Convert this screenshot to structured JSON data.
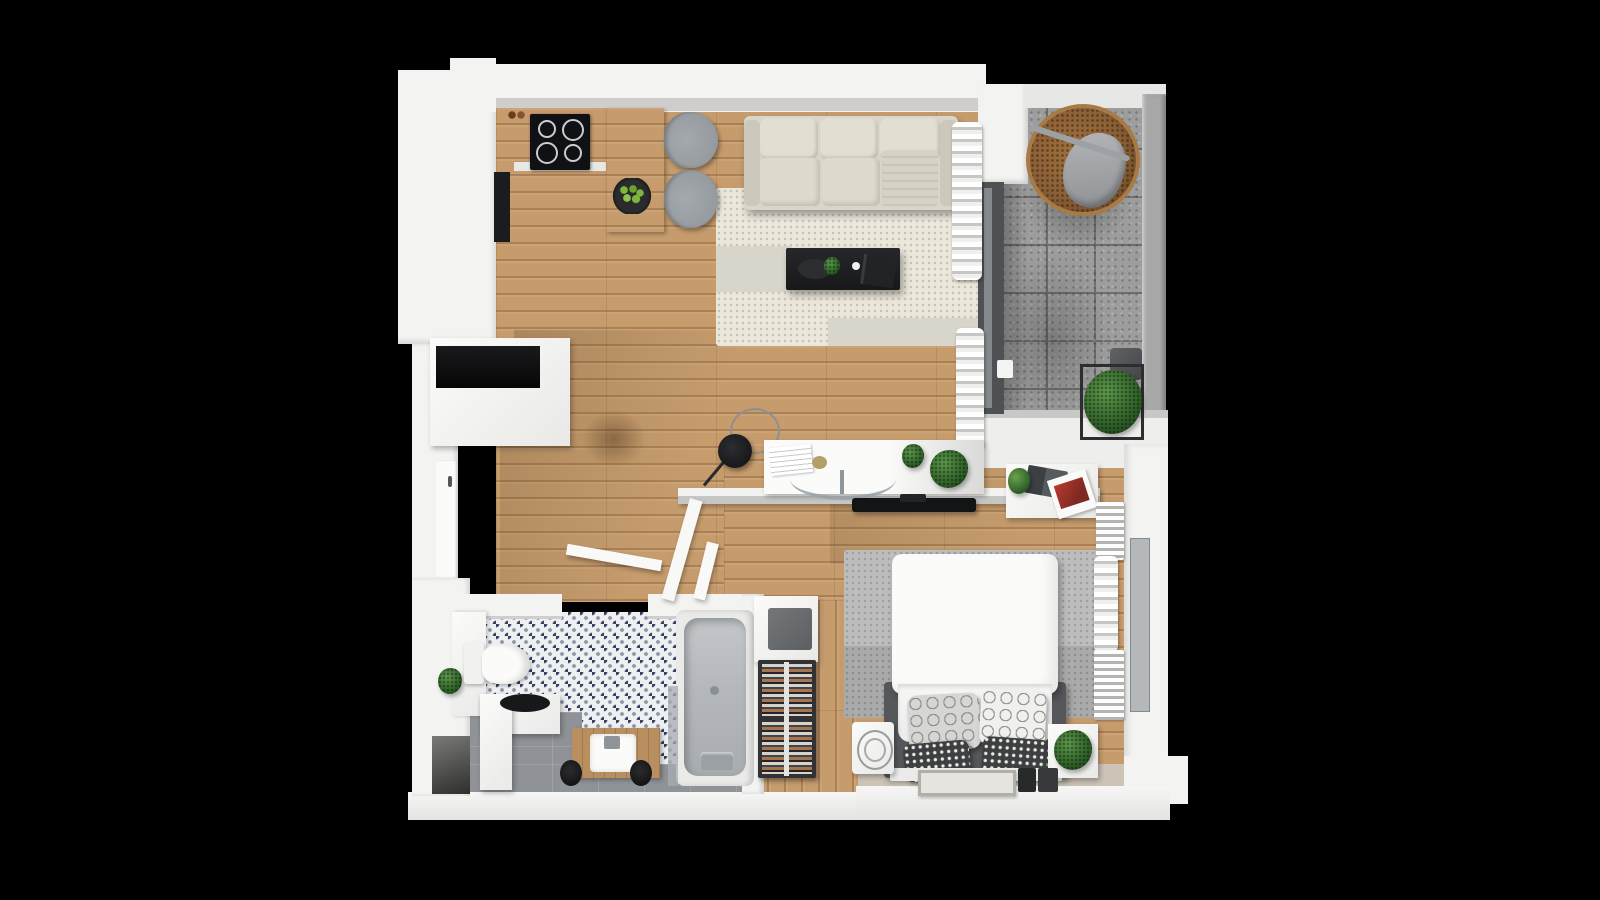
{
  "scene": {
    "type": "3d-floor-plan-top-view",
    "description": "Top-down 3D render of a one-bedroom apartment floor plan on a black background",
    "background": "#000000"
  },
  "palette": {
    "bg": "#000000",
    "wall": "#f3f3f1",
    "wallShade": "#d7d6d4",
    "wallLip": "#cfcecc",
    "wood": "#c69c6d",
    "woodVanity": "#b98f5f",
    "rugCream": "#ebe7db",
    "rugGrayPatch": "#d8d5cb",
    "bedroomRug": "#bdbdbd",
    "bedroomRugDark": "#aaaaaa",
    "balcony": "#9d9d9d",
    "grout": "#6e6e6e",
    "railing": "#a8a8a8",
    "glassWall": "#4e5154",
    "glassLine": "#84898c",
    "tileBase": "#edeff1",
    "tileNavy": "#36425f",
    "tileGray": "#8d95a5",
    "grayTile": "#8f9296",
    "sofa": "#d9d5c9",
    "sofaCushion": "#e2ded2",
    "blackFurniture": "#1b1c1e",
    "chairGray": "#969ba0",
    "tubInner": "#b4b8bb",
    "bedFrame": "#56575b",
    "bedWhite": "#fbfbfa",
    "pillowDark": "#3e3f41",
    "rattan": "#8a5f36",
    "tanFloor": "#cdc4b7",
    "accentRed": "#b8392e",
    "curtain": "#f6f6f4",
    "greenApple": "#7cb63c"
  },
  "rooms": {
    "kitchen": {
      "label": "kitchen",
      "items": [
        "cooktop-stove",
        "kitchen-counter",
        "peninsula-counter",
        "fruit-bowl-green-apples",
        "dining-chair",
        "dining-chair",
        "tall-oven-column",
        "spice-jars"
      ]
    },
    "living_room": {
      "label": "living-room",
      "items": [
        "three-seat-sofa",
        "cream-area-rug",
        "black-coffee-table",
        "arc-floor-lamp",
        "sheer-wavy-curtains",
        "sliding-glass-door"
      ]
    },
    "study_nook": {
      "label": "study-nook",
      "items": [
        "white-console-desk",
        "acrylic-chair",
        "papers",
        "potted-plants",
        "wall-mounted-tv",
        "half-wall-partition"
      ]
    },
    "hallway": {
      "label": "hallway",
      "items": [
        "console-cabinet-black-niche",
        "entrance-door",
        "interior-door",
        "interior-door"
      ]
    },
    "bathroom": {
      "label": "bathroom",
      "items": [
        "toilet",
        "wood-vanity-with-sink",
        "black-vessel-sink-counter",
        "bathtub",
        "stool",
        "stool",
        "patterned-moroccan-tile",
        "glass-partition"
      ]
    },
    "laundry": {
      "label": "laundry-nook",
      "items": [
        "washing-machine",
        "wine-rack"
      ]
    },
    "bedroom": {
      "label": "bedroom",
      "items": [
        "double-bed",
        "patterned-pillows",
        "gray-rug",
        "bedroom-desk",
        "laptop",
        "magazine",
        "fan-heater",
        "nightstand",
        "potted-plant",
        "doormat",
        "radiator",
        "radiator",
        "window",
        "wavy-curtain"
      ]
    },
    "balcony": {
      "label": "balcony",
      "items": [
        "hanging-egg-chair",
        "potted-plant",
        "side-stool",
        "concrete-tile-floor",
        "glass-railing"
      ]
    }
  }
}
